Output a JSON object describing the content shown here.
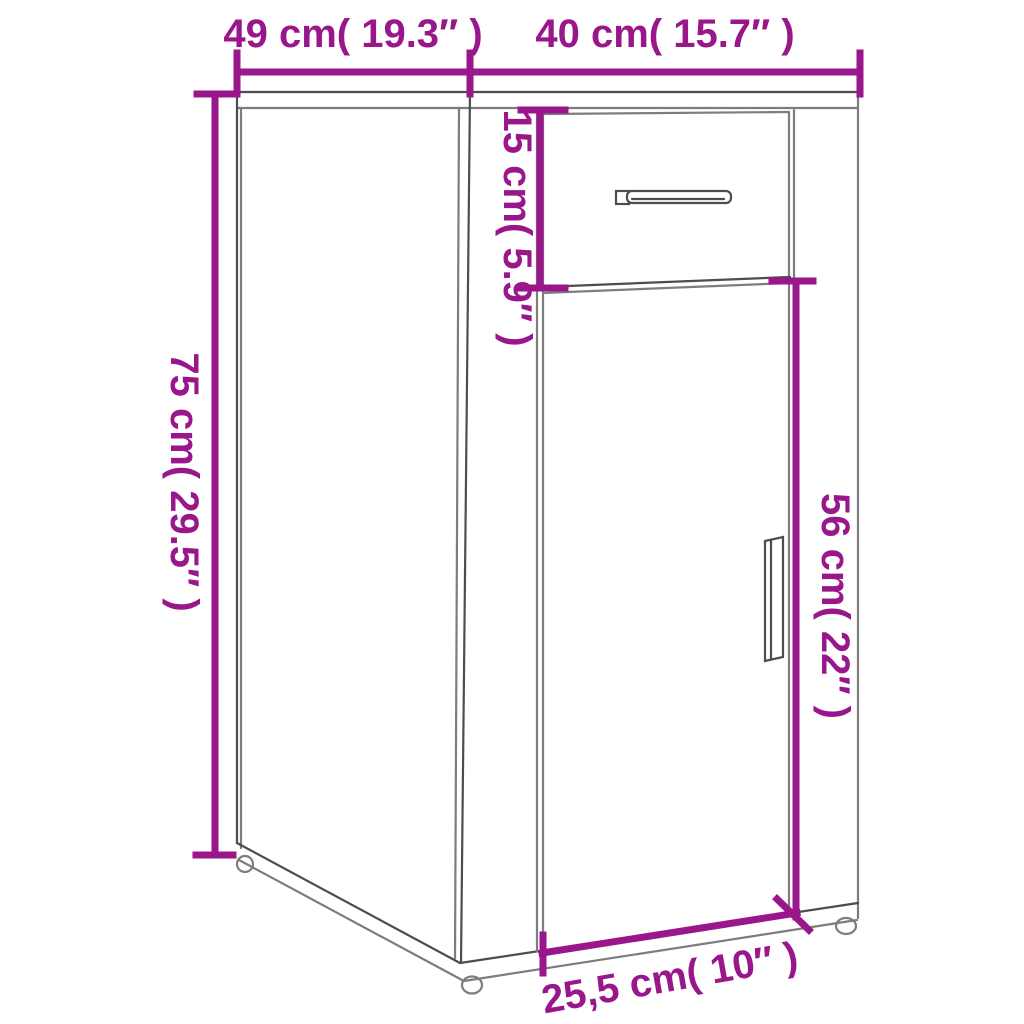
{
  "diagram": {
    "product": "cabinet-with-drawer-and-door",
    "dimensions": {
      "depth": {
        "label": "49 cm( 19.3″ )"
      },
      "width": {
        "label": "40 cm( 15.7″ )"
      },
      "height": {
        "label": "75 cm( 29.5″ )"
      },
      "drawer_height": {
        "label": "15 cm( 5.9″ )"
      },
      "door_height": {
        "label": "56 cm( 22″ )"
      },
      "door_width": {
        "label": "25,5 cm( 10″ )"
      }
    }
  },
  "colors": {
    "accent": "#99168B",
    "outline": "#7D7D7D",
    "outline_dark": "#4D4D4D",
    "background": "#FFFFFF"
  }
}
